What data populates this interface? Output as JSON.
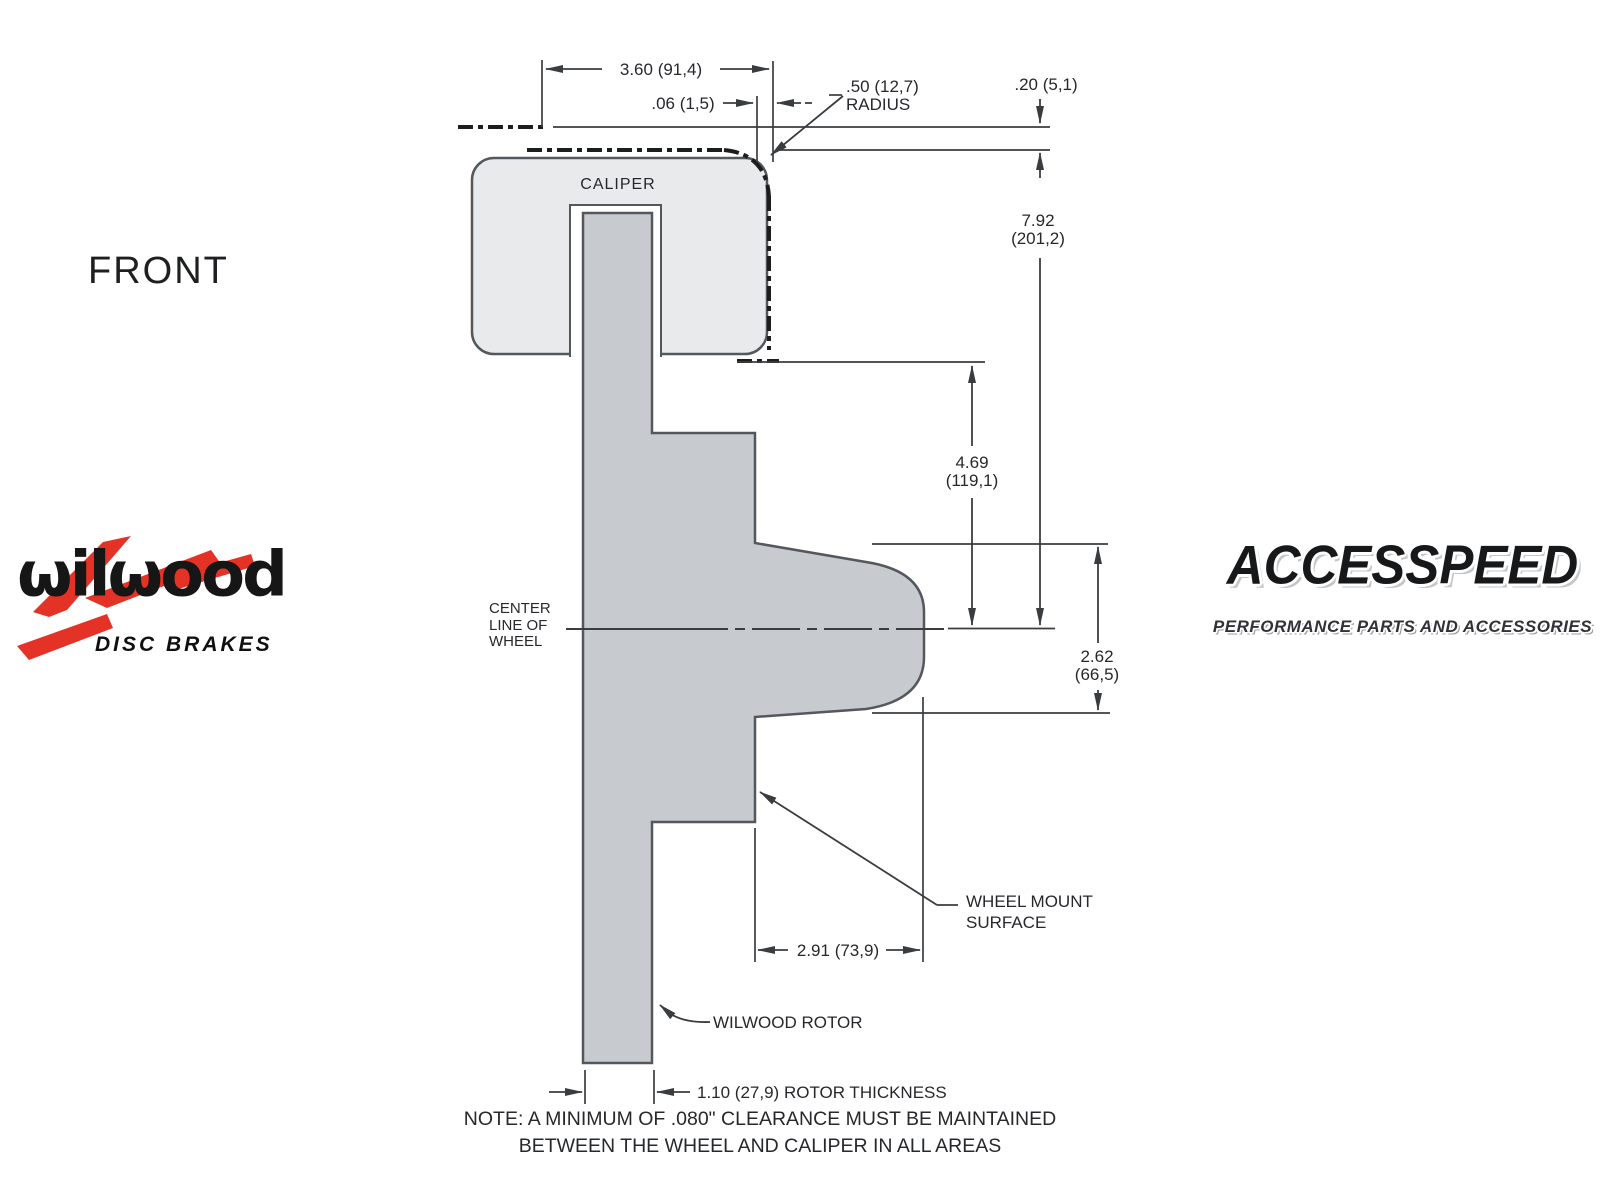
{
  "view": {
    "label": "FRONT"
  },
  "drawing": {
    "caliper_label": "CALIPER",
    "center_line": [
      "CENTER",
      "LINE OF",
      "WHEEL"
    ],
    "wheel_mount_surface": [
      "WHEEL MOUNT",
      "SURFACE"
    ],
    "rotor_label": "WILWOOD ROTOR"
  },
  "dimensions": {
    "caliper_overall_width": "3.60 (91,4)",
    "caliper_to_wheel_gap": ".06 (1,5)",
    "corner_radius": ".50 (12,7)",
    "corner_radius_suffix": "RADIUS",
    "wheel_lip": ".20 (5,1)",
    "wheel_inner_to_center": [
      "7.92",
      "(201,2)"
    ],
    "lip_to_center": [
      "4.69",
      "(119,1)"
    ],
    "hat_depth": [
      "2.62",
      "(66,5)"
    ],
    "mount_face_offset": "2.91 (73,9)",
    "rotor_thickness": "1.10 (27,9) ROTOR THICKNESS"
  },
  "note": {
    "line1": "NOTE: A MINIMUM OF .080\" CLEARANCE MUST BE MAINTAINED",
    "line2": "BETWEEN THE WHEEL AND CALIPER IN ALL AREAS"
  },
  "logos": {
    "wilwood_name": "ωilωood",
    "wilwood_tagline": "DISC BRAKES",
    "accesspeed_name": "ACCESSPEED",
    "accesspeed_tagline": "PERFORMANCE PARTS AND ACCESSORIES"
  },
  "colors": {
    "rotor_fill": "#c7cbd0",
    "caliper_fill": "#e8eaec",
    "line": "#3a3d40",
    "phantom_line": "#1b1d1f",
    "brand_red": "#e53226"
  }
}
